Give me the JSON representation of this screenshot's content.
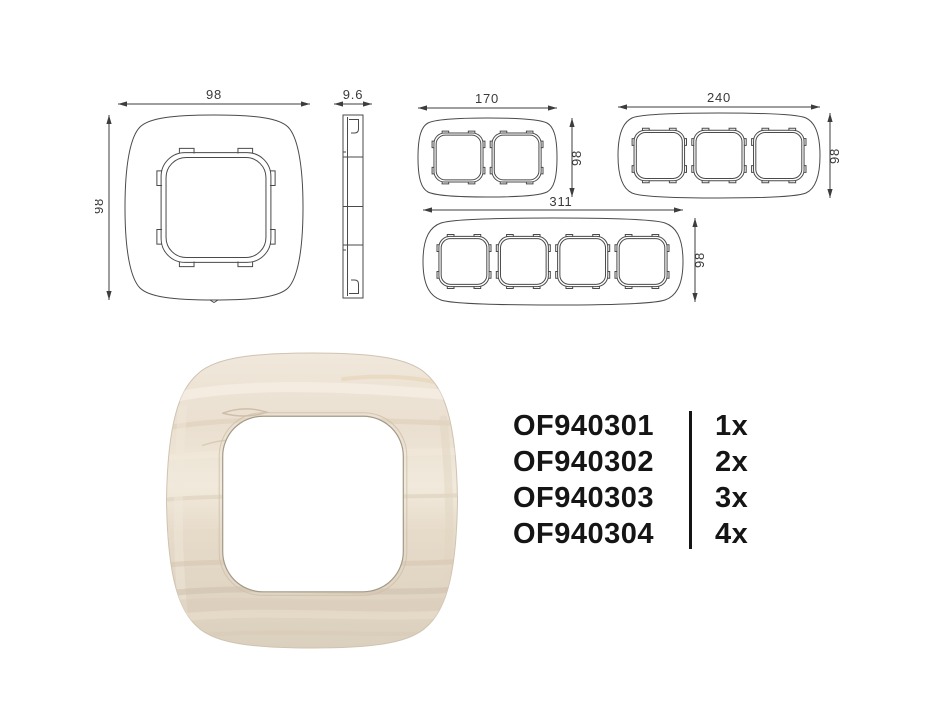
{
  "drawings": {
    "single_front": {
      "width_label": "98",
      "height_label": "98"
    },
    "side_profile": {
      "depth_label": "9.6"
    },
    "two_gang": {
      "width_label": "170",
      "height_label": "98"
    },
    "three_gang": {
      "width_label": "240",
      "height_label": "98"
    },
    "four_gang": {
      "width_label": "311",
      "height_label": "98"
    }
  },
  "product_list": {
    "items": [
      {
        "code": "OF940301",
        "qty": "1x"
      },
      {
        "code": "OF940302",
        "qty": "2x"
      },
      {
        "code": "OF940303",
        "qty": "3x"
      },
      {
        "code": "OF940304",
        "qty": "4x"
      }
    ]
  },
  "colors": {
    "drawing_line": "#4a4a4a",
    "dimension_text": "#3a3a3a",
    "code_text": "#151515",
    "wood_base": "#ece2d4",
    "wood_light": "#f4eee4",
    "wood_dark": "#d7c9b6",
    "wood_tan": "#e0cdb2",
    "aperture_fill": "#ffffff"
  }
}
